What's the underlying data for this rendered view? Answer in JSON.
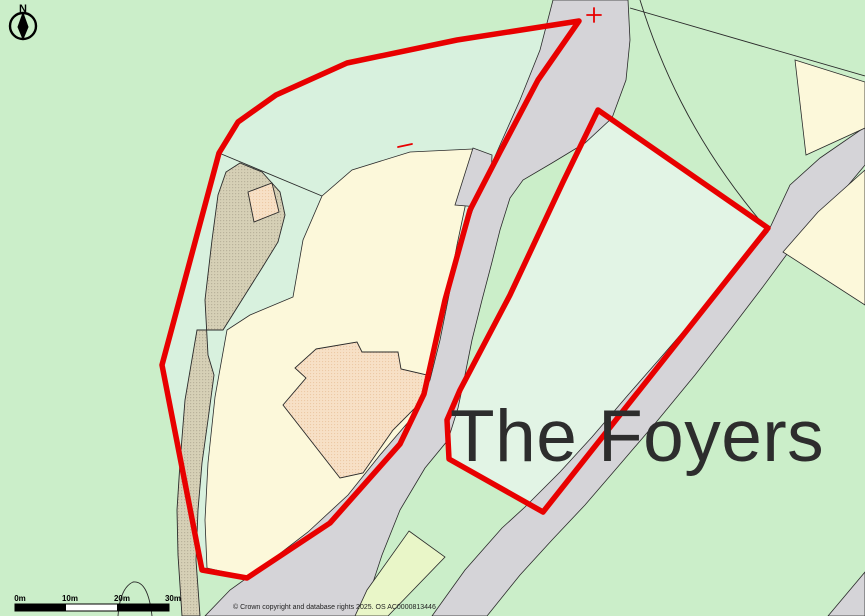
{
  "map": {
    "place_label": "The Foyers",
    "copyright_text": "© Crown copyright and database rights 2025. OS AC0000813446",
    "compass": {
      "label": "N",
      "icon": "north-arrow-icon"
    },
    "scale_bar": {
      "labels": [
        "0m",
        "10m",
        "20m",
        "30m"
      ]
    },
    "markers": {
      "cross_icon": "red-cross-marker",
      "dash_icon": "red-dash-marker"
    },
    "legend_meaning": {
      "red_outline": "site boundary"
    },
    "colors": {
      "green_outer": "#cbeec9",
      "mint_left": "#d8f1de",
      "mint_right": "#e2f4e5",
      "cream": "#fcf8da",
      "road": "#d5d4d8",
      "track": "#d6d0b6",
      "track_dot": "#b9b29b",
      "building": "#f7e0c6",
      "building_dot": "#ecc9a6",
      "strip": "#e9f6c8",
      "boundary_red": "#e80000",
      "thin_line": "#2a2a2a",
      "label_dark": "#2d2d2d"
    }
  }
}
